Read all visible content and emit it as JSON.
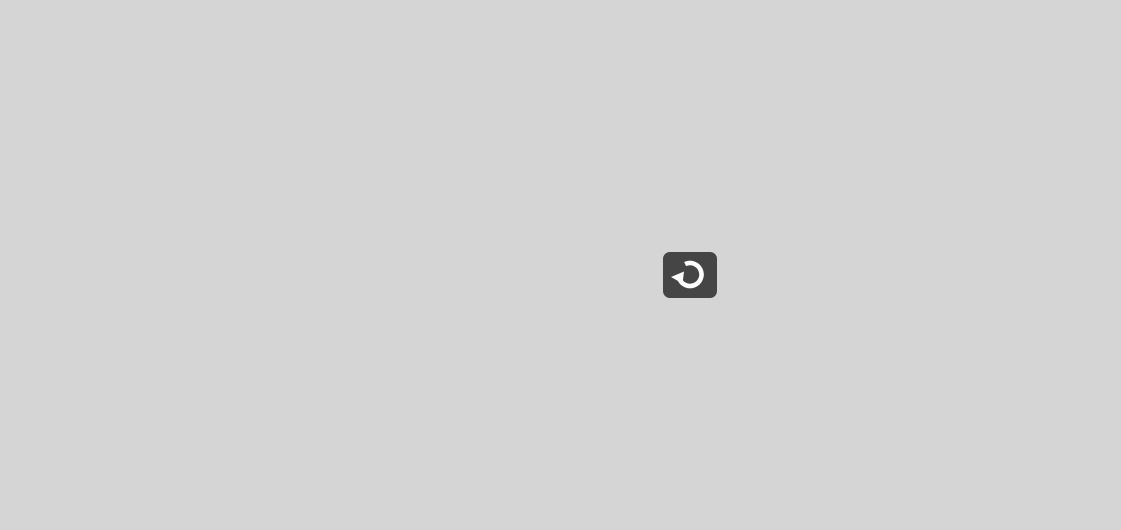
{
  "game": {
    "type": "endless-runner",
    "character": "pixel-t-rex",
    "restart_button": {
      "label": "Restart",
      "icon": "restart-circular-arrow"
    }
  },
  "hallway": {
    "lockers_left": {
      "numbers": [
        "172",
        "173",
        "174"
      ]
    },
    "lockers_right": {
      "numbers": [
        "216",
        "217",
        "218",
        "219",
        "220"
      ]
    },
    "bulletin_board_left": {
      "paper_count": 8
    },
    "bulletin_board_right": {
      "paper_count": 8
    },
    "windows": {
      "count": 2,
      "buildings_visible": true
    },
    "ceiling_lights": {
      "count": 9
    },
    "sprinklers": {
      "count": 3
    }
  },
  "colors": {
    "wall": "#d5d5d5",
    "ceiling_bar": "#3d3d3d",
    "dino": "#4d4d4d",
    "restart_bg": "#454545",
    "ground_dark": "#4f4f4f",
    "floor_stripe_a": "#ffffff",
    "floor_stripe_b": "#cbcbcb"
  }
}
